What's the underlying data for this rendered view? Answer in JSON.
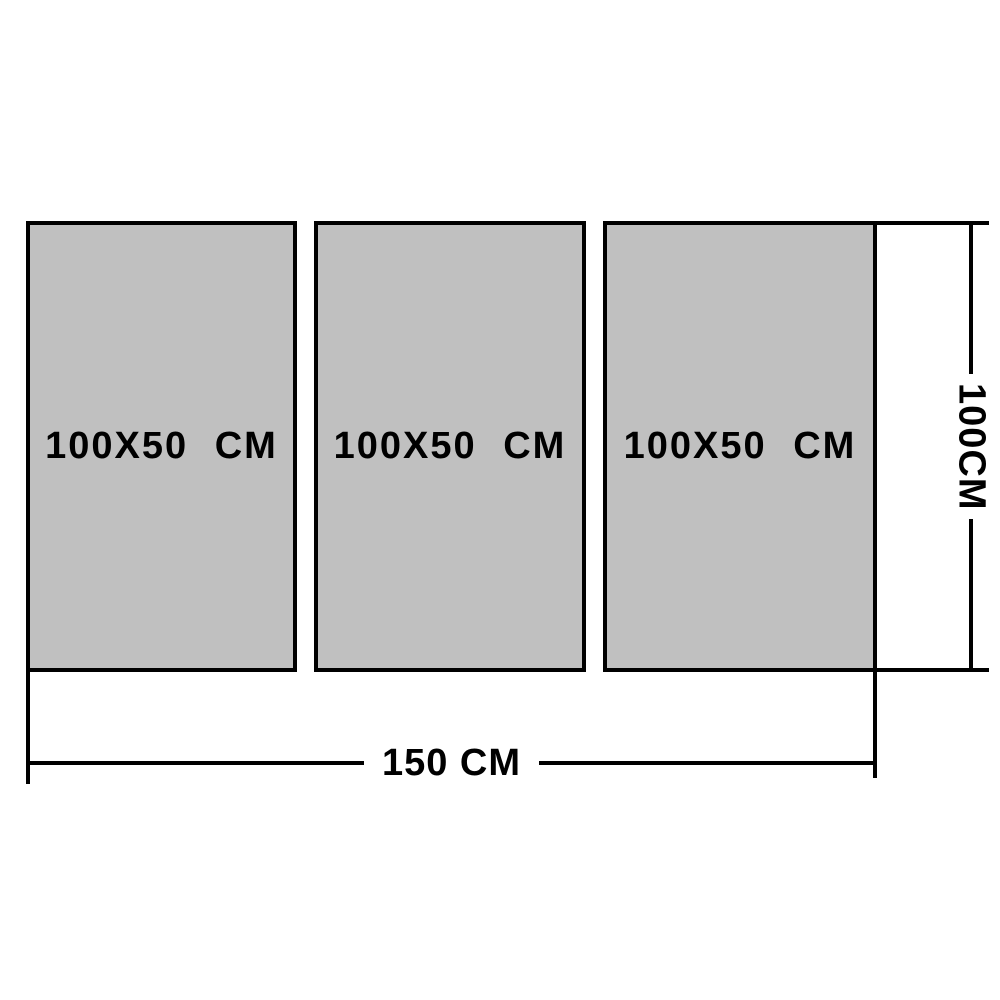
{
  "diagram": {
    "panels": [
      {
        "label": "100X50 CM"
      },
      {
        "label": "100X50 CM"
      },
      {
        "label": "100X50 CM"
      }
    ],
    "dimensions": {
      "total_width_label": "150 CM",
      "total_height_label": "100CM"
    },
    "colors": {
      "panel_fill": "#c0c0c0",
      "panel_border": "#000000",
      "dimension_line": "#000000",
      "text": "#000000",
      "background": "#ffffff"
    }
  }
}
